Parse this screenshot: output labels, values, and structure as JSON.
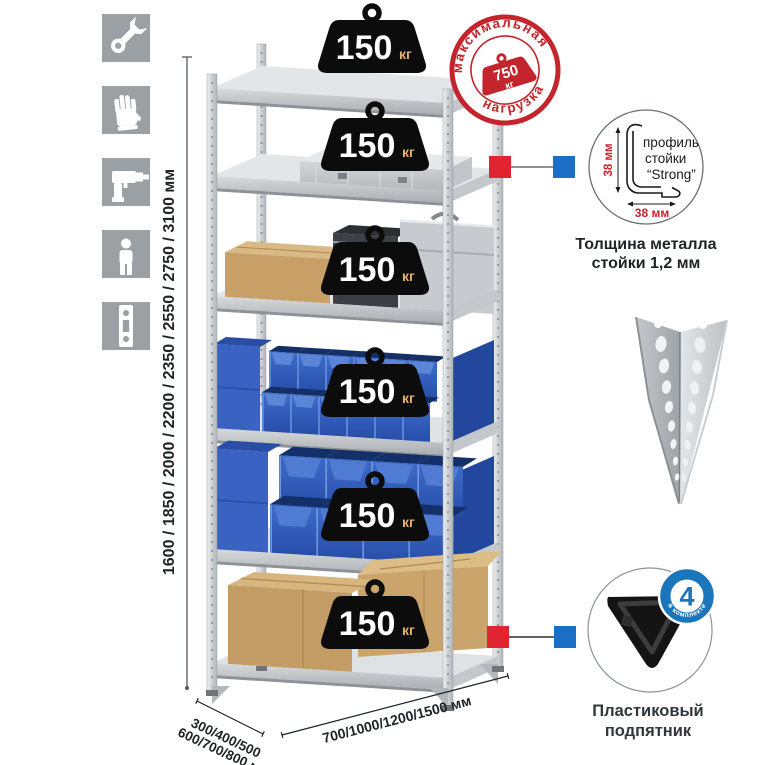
{
  "sidebar": {
    "icons": [
      {
        "name": "wrench"
      },
      {
        "name": "gloves"
      },
      {
        "name": "drill"
      },
      {
        "name": "person"
      },
      {
        "name": "rack-upright-profile"
      }
    ]
  },
  "dimensions": {
    "height": "1600 / 1850 / 2000 / 2200 / 2350 / 2550 / 2750 / 3100 мм",
    "depth_line1": "300/400/500",
    "depth_line2": "600/700/800 мм",
    "width": "700/1000/1200/1500 мм"
  },
  "max_load_stamp": {
    "arc_top": "максимальная",
    "arc_bottom": "нагрузка",
    "value": "750",
    "unit": "кг"
  },
  "shelf_load": {
    "value": "150",
    "unit": "кг",
    "shelves_count": 6
  },
  "profile_detail": {
    "label_line1": "профиль",
    "label_line2": "стойки",
    "label_line3": "“Strong”",
    "dim_vertical": "38 мм",
    "dim_horizontal": "38 мм",
    "caption_line1": "Толщина металла",
    "caption_line2": "стойки 1,2 мм"
  },
  "foot_detail": {
    "badge_value": "4",
    "badge_arc": "в комплекте",
    "caption_line1": "Пластиковый",
    "caption_line2": "подпятник"
  },
  "colors": {
    "accent_red": "#d8232e",
    "accent_blue": "#1b6fc4",
    "badge_blue": "#1b75bb",
    "metal_light": "#d6d9dc",
    "bin_blue": "#2d5ec0",
    "cardboard": "#c9a36b"
  }
}
